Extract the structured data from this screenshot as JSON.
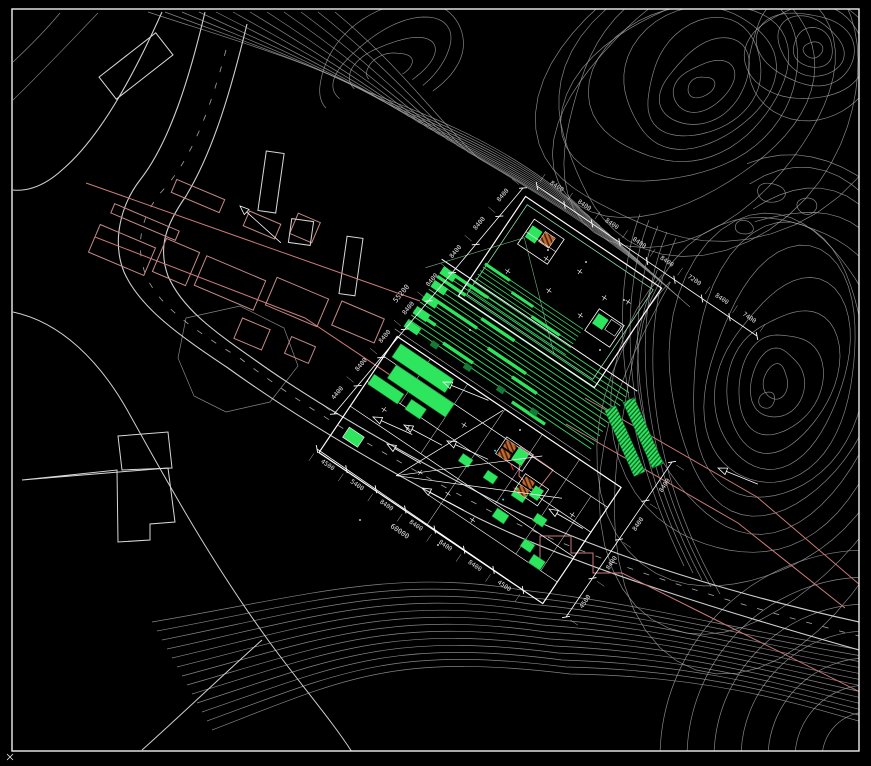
{
  "title": "Architectural site plan - CAD drawing with topographic contours",
  "colors": {
    "background": "#000000",
    "frame": "#f0f0f0",
    "contour": "#a6a6a6",
    "road": "#cfcfcf",
    "existing_building": "#c68a8a",
    "boundary_pink": "#c97b7b",
    "red_accent": "#e03030",
    "new_building_outline": "#ffffff",
    "setback_green": "#8fd9a8",
    "fill_green": "#2ee65e",
    "stripe_green": "#3ed468",
    "dark_green": "#157a35",
    "core_orange": "#bf6a2e",
    "core_brown": "#4a1f0a",
    "dimension_text": "#e6e6e6",
    "cyan_accent": "#27d7d7"
  },
  "dimensions": {
    "chain_nw": {
      "labels": [
        "4400",
        "8400",
        "8400",
        "8400",
        "8400",
        "8400",
        "8400",
        "8400"
      ],
      "total": "55200"
    },
    "chain_ne": {
      "labels": [
        "8400",
        "8400",
        "8400",
        "8400",
        "8400",
        "7200",
        "8400",
        "7400"
      ],
      "total": ""
    },
    "chain_sw": {
      "labels": [
        "4500",
        "5400",
        "8400",
        "8400",
        "8400",
        "8400",
        "4500"
      ],
      "total": "60000"
    },
    "chain_se": {
      "labels": [
        "4500",
        "8400",
        "8400",
        "8400"
      ],
      "total": ""
    }
  },
  "features": {
    "contours": "contour-lines",
    "roads": "site-roads",
    "existing": "existing-buildings",
    "upper_building": "proposed-building-upper",
    "lower_building": "proposed-building-lower",
    "terrace": "terraced-steps",
    "ramp": "access-ramp"
  }
}
